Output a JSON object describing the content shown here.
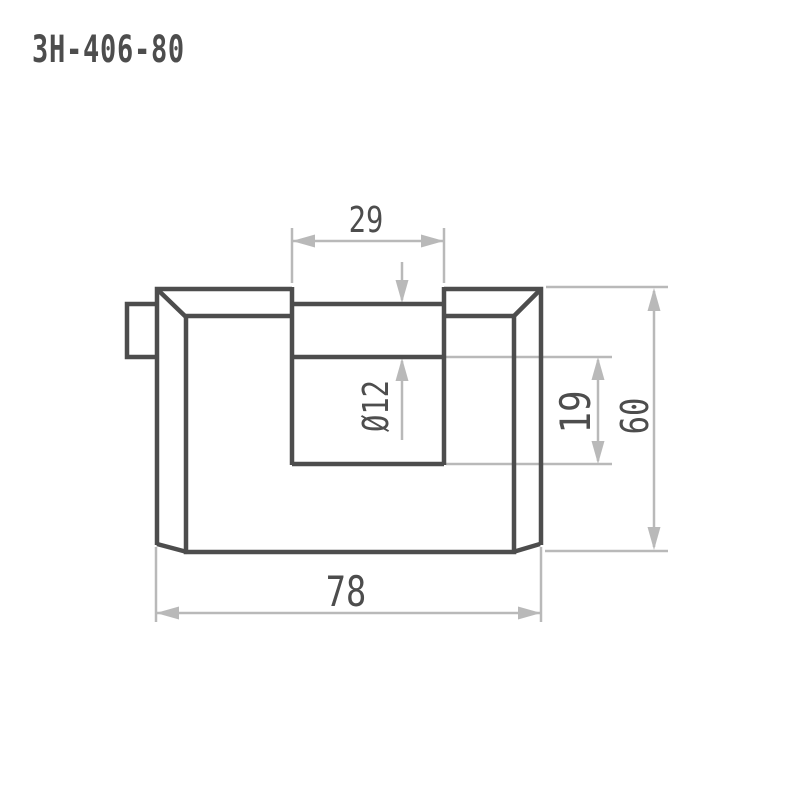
{
  "title": "ЗН-406-80",
  "drawing": {
    "type": "technical-drawing",
    "subject": "padlock-front-view"
  },
  "colors": {
    "background": "#ffffff",
    "outline_dark": "#4d4d4d",
    "dimension_light": "#b9b9b9",
    "text": "#4d4d4d"
  },
  "dims": {
    "gap": {
      "label": "29",
      "meaning": "shackle opening width"
    },
    "diameter": {
      "label": "Ø12",
      "meaning": "shackle rod diameter"
    },
    "notch": {
      "label": "19",
      "meaning": "opening height below rod"
    },
    "height": {
      "label": "60",
      "meaning": "overall body height"
    },
    "width": {
      "label": "78",
      "meaning": "overall body width"
    }
  }
}
